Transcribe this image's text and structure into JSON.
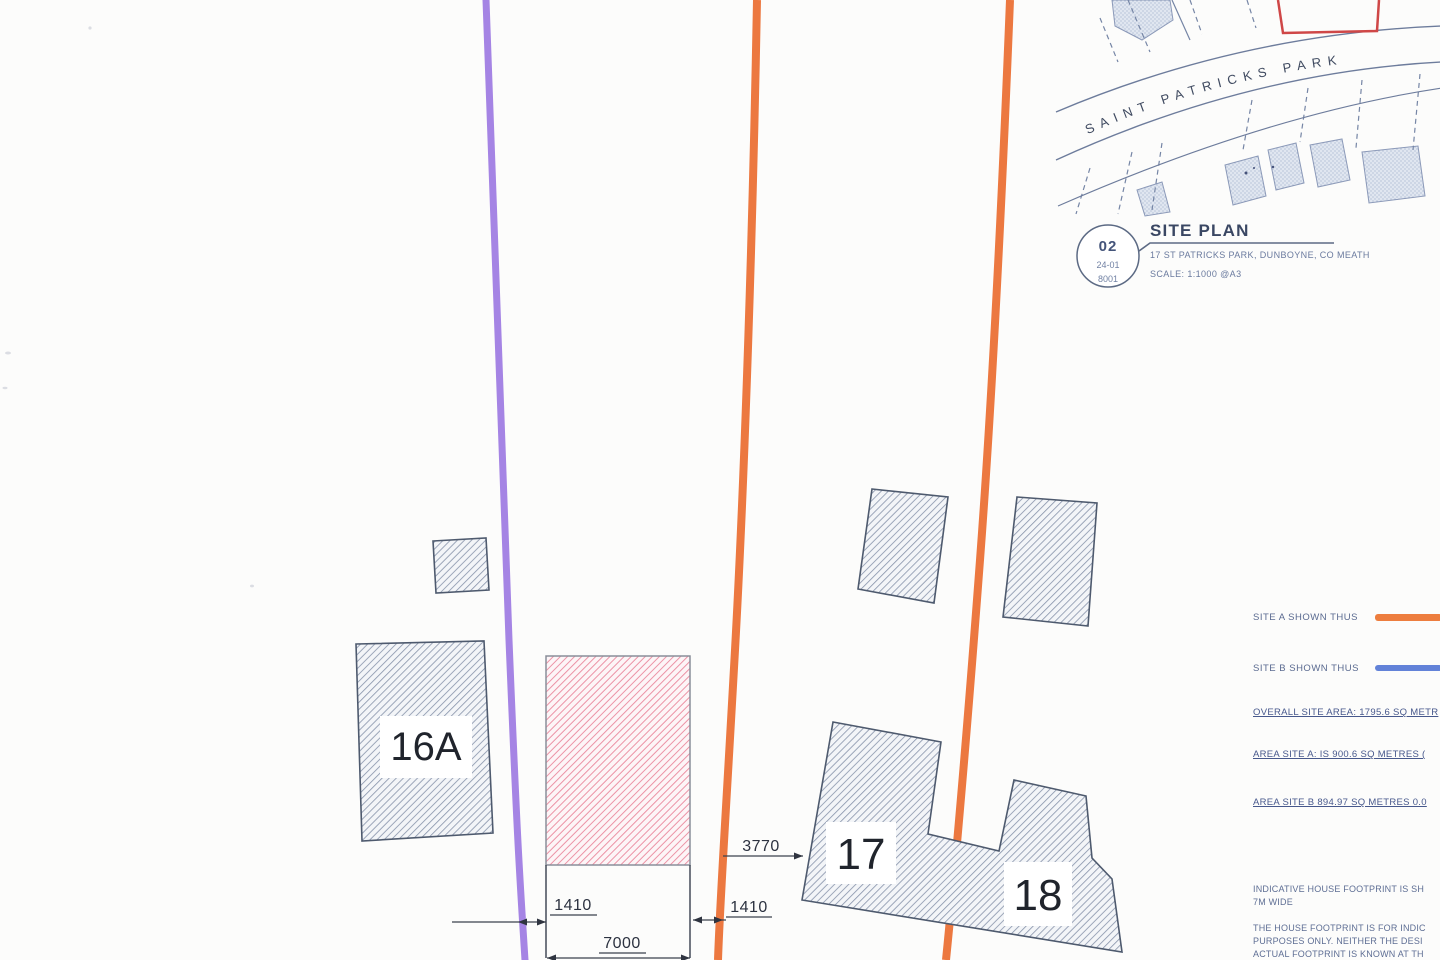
{
  "inset_map": {
    "street_name": "SAINT PATRICKS PARK",
    "red_outline_color": "#cf4747"
  },
  "title_block": {
    "drawing_number": "02",
    "project_code": "24-01",
    "sheet_code": "8001",
    "title": "SITE PLAN",
    "subtitle": "17 ST PATRICKS PARK, DUNBOYNE, CO MEATH",
    "scale": "SCALE: 1:1000 @A3"
  },
  "legend": {
    "site_a_label": "SITE A SHOWN THUS",
    "site_b_label": "SITE B SHOWN THUS",
    "site_a_color": "#ed7d3e",
    "site_b_color": "#6282d8",
    "overall_area": "OVERALL SITE AREA: 1795.6 SQ METR",
    "area_site_a": "AREA SITE A: IS 900.6 SQ METRES (",
    "area_site_b": "AREA SITE B 894.97 SQ METRES  0.0"
  },
  "notes": {
    "line1": "INDICATIVE HOUSE FOOTPRINT IS SH",
    "line2": "7M WIDE",
    "line3": "THE HOUSE FOOTPRINT IS FOR INDIC",
    "line4": "PURPOSES ONLY. NEITHER THE DESI",
    "line5": "ACTUAL FOOTPRINT IS KNOWN AT TH"
  },
  "plan": {
    "plot_labels": {
      "p16a": "16A",
      "p17": "17",
      "p18": "18"
    },
    "dimensions": {
      "left_offset": "1410",
      "right_offset": "1410",
      "footprint_width": "7000",
      "site_gap": "3770"
    },
    "colors": {
      "site_a_line": "#ec7840",
      "site_b_line": "#a584e4",
      "building_hatch": "#8793aa",
      "proposed_hatch": "#ec93a6",
      "dimension": "#3b414e"
    }
  }
}
